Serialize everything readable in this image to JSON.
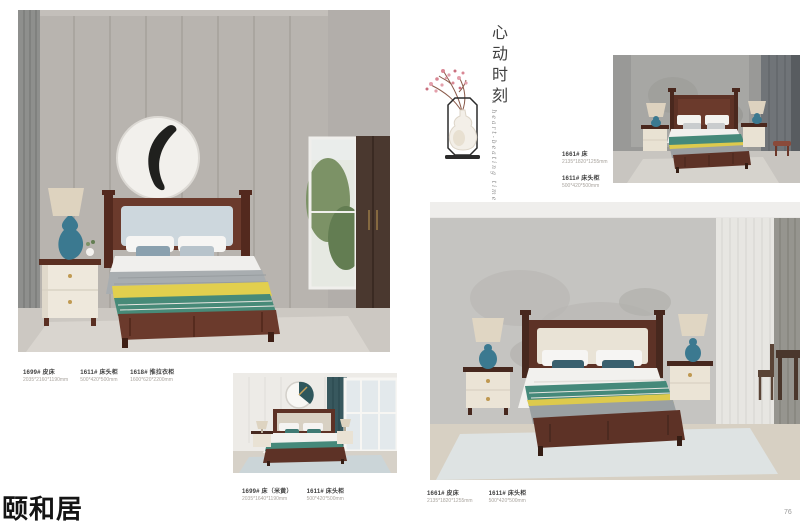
{
  "page": {
    "brand": "颐和居",
    "page_number": "76"
  },
  "decor": {
    "vertical_title": "心动时刻",
    "script_caption": "a heart-beating time"
  },
  "captions": {
    "left": {
      "items": [
        {
          "name": "1699# 皮床",
          "dims": "2035*2160*1190mm"
        },
        {
          "name": "1611# 床头柜",
          "dims": "500*420*500mm"
        },
        {
          "name": "1618# 推拉衣柜",
          "dims": "1600*620*2200mm"
        }
      ]
    },
    "top_right": {
      "items": [
        {
          "name": "1661# 床",
          "dims": "2135*1820*1255mm"
        },
        {
          "name": "1611# 床头柜",
          "dims": "500*420*500mm"
        }
      ]
    },
    "bottom_middle": {
      "items": [
        {
          "name": "1699# 床（米黄）",
          "dims": "2035*1640*1190mm"
        },
        {
          "name": "1611# 床头柜",
          "dims": "500*420*500mm"
        }
      ]
    },
    "bottom_right": {
      "items": [
        {
          "name": "1661# 皮床",
          "dims": "2135*1820*1255mm"
        },
        {
          "name": "1611# 床头柜",
          "dims": "500*420*500mm"
        }
      ]
    }
  },
  "colors": {
    "wood_brown": "#5d3226",
    "teal_throw": "#45897a",
    "yellow_throw": "#e2cf4e",
    "lamp_blue": "#3b7990",
    "wall_gray": "#b5b1ac",
    "blossom_pink": "#e3a0ac"
  }
}
